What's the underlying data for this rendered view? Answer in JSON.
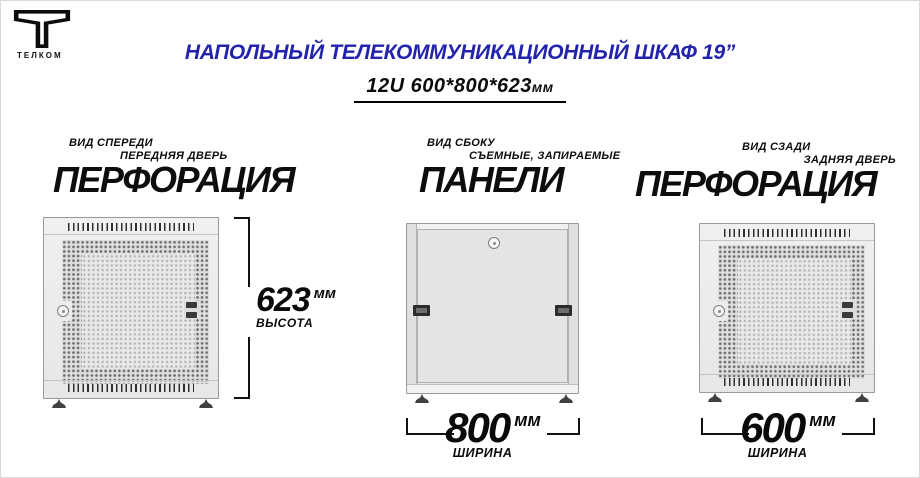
{
  "brand": {
    "name": "ТЕЛКОМ"
  },
  "header": {
    "title": "НАПОЛЬНЫЙ ТЕЛЕКОММУНИКАЦИОННЫЙ ШКАФ 19”",
    "subtitle_main": "12U 600*800*623",
    "subtitle_unit": "мм"
  },
  "views": [
    {
      "view_label": "ВИД СПЕРЕДИ",
      "sub_label": "ПЕРЕДНЯЯ ДВЕРЬ",
      "feature": "ПЕРФОРАЦИЯ"
    },
    {
      "view_label": "ВИД СБОКУ",
      "sub_label": "СЪЕМНЫЕ, ЗАПИРАЕМЫЕ",
      "feature": "ПАНЕЛИ"
    },
    {
      "view_label": "ВИД СЗАДИ",
      "sub_label": "ЗАДНЯЯ ДВЕРЬ",
      "feature": "ПЕРФОРАЦИЯ"
    }
  ],
  "dimensions": {
    "height": {
      "value": "623",
      "unit": "мм",
      "label": "ВЫСОТА"
    },
    "width_side": {
      "value": "800",
      "unit": "мм",
      "label": "ШИРИНА"
    },
    "width_rear": {
      "value": "600",
      "unit": "мм",
      "label": "ШИРИНА"
    }
  },
  "colors": {
    "title_blue": "#2323AE",
    "text_black": "#0A0A0A",
    "cabinet_body": "#EBEBEB",
    "cabinet_border": "#9A9A9A",
    "perforation_dark": "#707070",
    "perforation_light": "#B4B4B4"
  }
}
